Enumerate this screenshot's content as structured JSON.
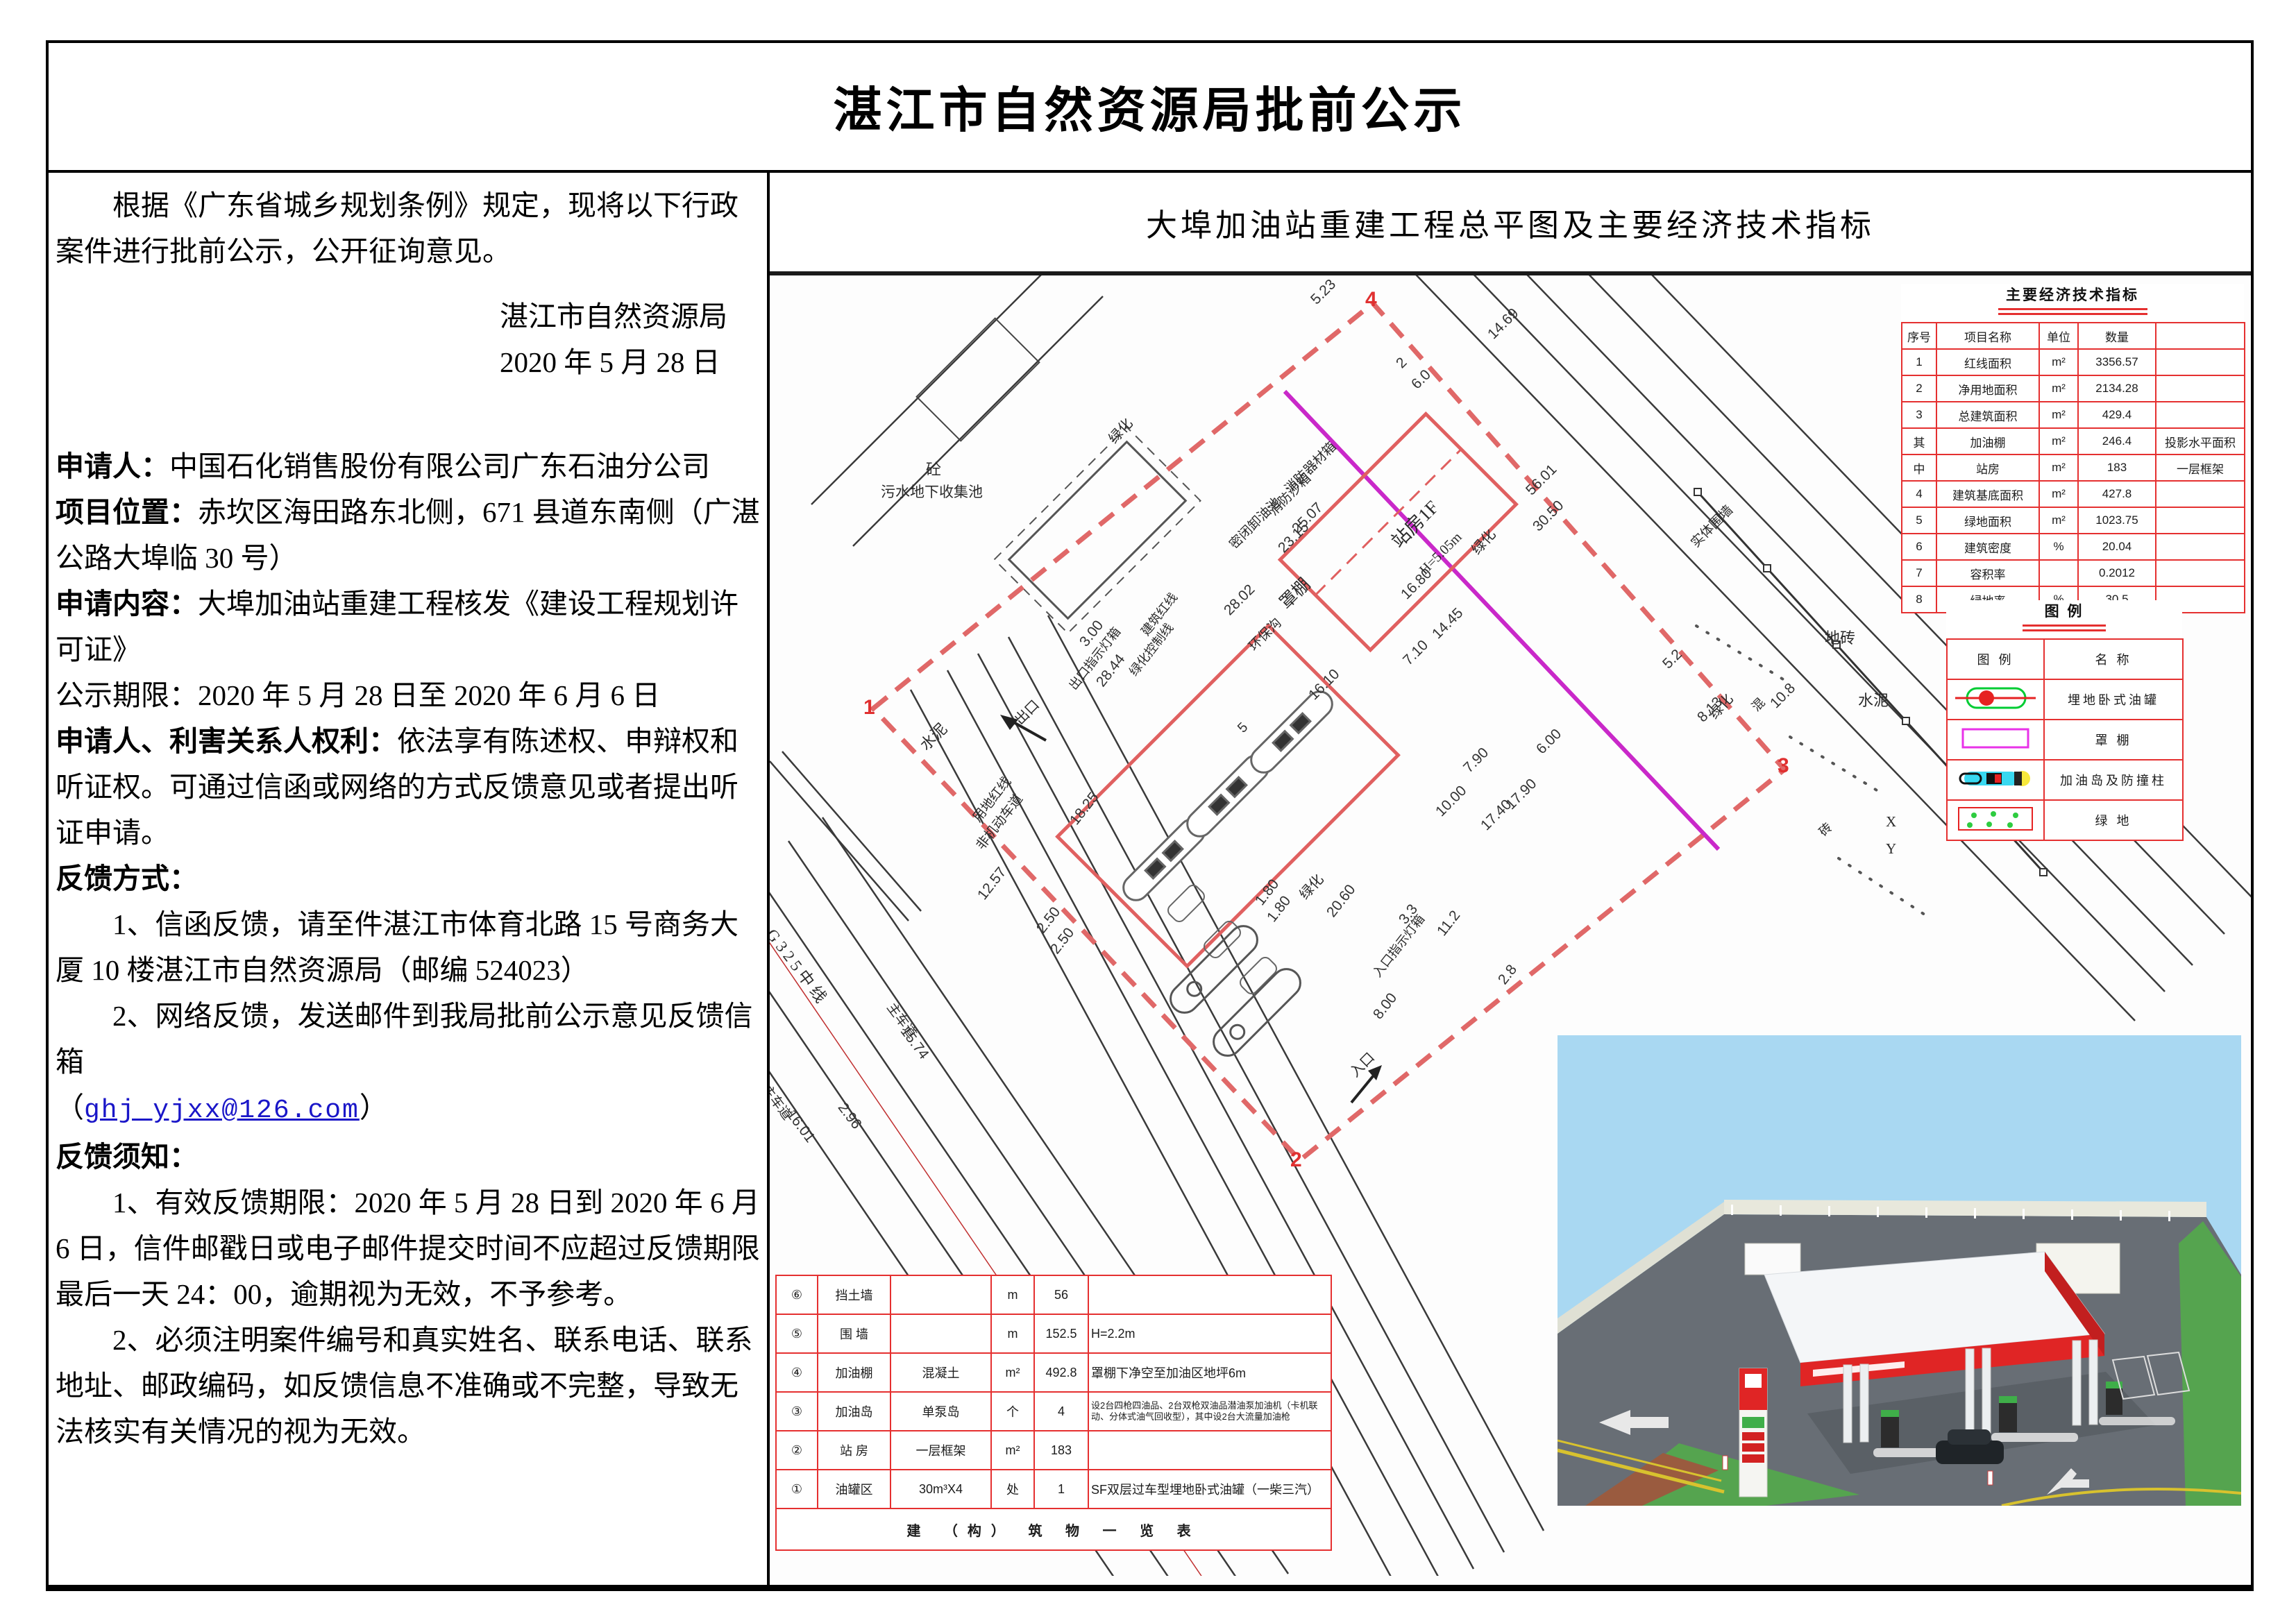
{
  "page": {
    "title": "湛江市自然资源局批前公示"
  },
  "left": {
    "intro": "根据《广东省城乡规划条例》规定，现将以下行政案件进行批前公示，公开征询意见。",
    "org": "湛江市自然资源局",
    "date": "2020 年 5 月 28 日",
    "fields": [
      {
        "label": "申请人：",
        "text": "中国石化销售股份有限公司广东石油分公司",
        "bold": true
      },
      {
        "label": "项目位置：",
        "text": "赤坎区海田路东北侧，671 县道东南侧（广湛公路大埠临 30 号）",
        "bold": true
      },
      {
        "label": "申请内容：",
        "text": "大埠加油站重建工程核发《建设工程规划许可证》",
        "bold": true
      },
      {
        "label": "公示期限：",
        "text": "2020 年 5 月 28 日至 2020 年 6 月 6 日",
        "bold": false
      },
      {
        "label": "申请人、利害关系人权利：",
        "text": "依法享有陈述权、申辩权和听证权。可通过信函或网络的方式反馈意见或者提出听证申请。",
        "bold": true
      }
    ],
    "feedback_method": {
      "heading": "反馈方式：",
      "item1": "1、信函反馈，请至件湛江市体育北路 15 号商务大厦 10 楼湛江市自然资源局（邮编 524023）",
      "item2": "2、网络反馈，发送邮件到我局批前公示意见反馈信箱",
      "paren_open": "（",
      "email": "ghj_yjxx@126.com",
      "paren_close": "）"
    },
    "feedback_notice": {
      "heading": "反馈须知：",
      "item1": "1、有效反馈期限：2020 年 5 月 28 日到 2020 年 6 月 6 日，信件邮戳日或电子邮件提交时间不应超过反馈期限最后一天 24：00，逾期视为无效，不予参考。",
      "item2": "2、必须注明案件编号和真实姓名、联系电话、联系地址、邮政编码，如反馈信息不准确或不完整，导致无法核实有关情况的视为无效。"
    }
  },
  "right": {
    "header": "大埠加油站重建工程总平图及主要经济技术指标"
  },
  "indicators": {
    "title": "主要经济技术指标",
    "headers": [
      "序号",
      "项目名称",
      "单位",
      "数量",
      ""
    ],
    "rows": [
      [
        "1",
        "红线面积",
        "m²",
        "3356.57",
        ""
      ],
      [
        "2",
        "净用地面积",
        "m²",
        "2134.28",
        ""
      ],
      [
        "3",
        "总建筑面积",
        "m²",
        "429.4",
        ""
      ],
      [
        "其",
        "加油棚",
        "m²",
        "246.4",
        "投影水平面积"
      ],
      [
        "中",
        "站房",
        "m²",
        "183",
        "一层框架"
      ],
      [
        "4",
        "建筑基底面积",
        "m²",
        "427.8",
        ""
      ],
      [
        "5",
        "绿地面积",
        "m²",
        "1023.75",
        ""
      ],
      [
        "6",
        "建筑密度",
        "%",
        "20.04",
        ""
      ],
      [
        "7",
        "容积率",
        "",
        "0.2012",
        ""
      ],
      [
        "8",
        "绿地率",
        "%",
        "30.5",
        ""
      ]
    ]
  },
  "legend": {
    "title": "图  例",
    "headers": [
      "图  例",
      "名  称"
    ],
    "rows": [
      {
        "symbol": "tank",
        "name": "埋地卧式油罐"
      },
      {
        "symbol": "canopy",
        "name": "罩  棚"
      },
      {
        "symbol": "island",
        "name": "加油岛及防撞柱"
      },
      {
        "symbol": "green",
        "name": "绿  地"
      }
    ]
  },
  "structures": {
    "rows": [
      {
        "no": "⑥",
        "name": "挡土墙",
        "spec": "",
        "unit": "m",
        "qty": "56",
        "remark": ""
      },
      {
        "no": "⑤",
        "name": "围 墙",
        "spec": "",
        "unit": "m",
        "qty": "152.5",
        "remark": "H=2.2m"
      },
      {
        "no": "④",
        "name": "加油棚",
        "spec": "混凝土",
        "unit": "m²",
        "qty": "492.8",
        "remark": "罩棚下净空至加油区地坪6m"
      },
      {
        "no": "③",
        "name": "加油岛",
        "spec": "单泵岛",
        "unit": "个",
        "qty": "4",
        "remark": "设2台四枪四油品、2台双枪双油品潜油泵加油机（卡机联动、分体式油气回收型），其中设2台大流量加油枪",
        "small": true
      },
      {
        "no": "②",
        "name": "站 房",
        "spec": "一层框架",
        "unit": "m²",
        "qty": "183",
        "remark": ""
      },
      {
        "no": "①",
        "name": "油罐区",
        "spec": "30m³X4",
        "unit": "处",
        "qty": "1",
        "remark": "SF双层过车型埋地卧式油罐（一柴三汽）"
      }
    ],
    "footer": "建 （构） 筑 物 一 览 表"
  },
  "plan": {
    "labels": [
      [
        "砼",
        225,
        262,
        0,
        22,
        "lab"
      ],
      [
        "污水地下收集池",
        160,
        296,
        0,
        21,
        "lab"
      ],
      [
        "绿化",
        480,
        228,
        -48,
        20,
        "lab"
      ],
      [
        "绿化",
        1003,
        388,
        -48,
        20,
        "lab"
      ],
      [
        "绿化",
        755,
        885,
        -48,
        20,
        "lab"
      ],
      [
        "绿化",
        1345,
        625,
        -48,
        20,
        "lab"
      ],
      [
        "消防器材箱",
        735,
        300,
        -45,
        19,
        "lab"
      ],
      [
        "消防沙箱",
        712,
        332,
        -45,
        19,
        "lab"
      ],
      [
        "密闭卸油池",
        655,
        380,
        -45,
        19,
        "lab"
      ],
      [
        "站房1F",
        885,
        372,
        -45,
        27,
        "lab"
      ],
      [
        "H=5.05m",
        932,
        420,
        -45,
        20,
        "lab"
      ],
      [
        "罩棚",
        725,
        462,
        -45,
        25,
        "lab"
      ],
      [
        "环保沟",
        683,
        527,
        -45,
        19,
        "lab"
      ],
      [
        "实体围墙",
        1320,
        378,
        -45,
        19,
        "lab"
      ],
      [
        "地砖",
        1520,
        505,
        0,
        22,
        "lab"
      ],
      [
        "水泥",
        1568,
        595,
        0,
        22,
        "lab"
      ],
      [
        "混",
        1408,
        615,
        -45,
        18,
        "lab"
      ],
      [
        "砖",
        1505,
        795,
        -45,
        18,
        "lab"
      ],
      [
        "X",
        1608,
        775,
        0,
        21,
        "lab"
      ],
      [
        "Y",
        1608,
        814,
        0,
        21,
        "lab"
      ],
      [
        "水泥",
        208,
        668,
        -45,
        22,
        "lab"
      ],
      [
        "出口",
        345,
        632,
        -45,
        20,
        "lab"
      ],
      [
        "出口指示灯箱",
        424,
        586,
        -52,
        18,
        "lab"
      ],
      [
        "入口",
        828,
        1140,
        -45,
        20,
        "lab"
      ],
      [
        "入口指示灯箱",
        862,
        1000,
        -52,
        18,
        "lab"
      ],
      [
        "用地红线",
        285,
        776,
        -52,
        19,
        "lab"
      ],
      [
        "建筑红线",
        528,
        508,
        -52,
        18,
        "lab"
      ],
      [
        "绿化控制线",
        511,
        566,
        -52,
        18,
        "lab"
      ],
      [
        "非机动车道",
        290,
        816,
        -52,
        19,
        "lab"
      ],
      [
        "主车道",
        185,
        1042,
        53,
        19,
        "lab"
      ],
      [
        "主车道",
        5,
        1160,
        53,
        19,
        "lab"
      ],
      [
        "G 3 2 5 中 线",
        16,
        933,
        53,
        23,
        "lab"
      ],
      [
        "14.69",
        1030,
        80,
        -45,
        21,
        "dim"
      ],
      [
        "5.23",
        775,
        30,
        -45,
        21,
        "dim"
      ],
      [
        "6.0",
        920,
        152,
        -45,
        21,
        "dim"
      ],
      [
        "2",
        898,
        122,
        -45,
        21,
        "dim"
      ],
      [
        "56.01",
        1085,
        305,
        -45,
        21,
        "dim"
      ],
      [
        "30.50",
        1095,
        357,
        -45,
        21,
        "dim"
      ],
      [
        "25.07",
        748,
        360,
        -45,
        21,
        "dim"
      ],
      [
        "23.15",
        728,
        388,
        -45,
        21,
        "dim"
      ],
      [
        "28.02",
        650,
        478,
        -45,
        21,
        "dim"
      ],
      [
        "16.10",
        772,
        600,
        -45,
        21,
        "dim"
      ],
      [
        "16.80",
        905,
        455,
        -45,
        21,
        "dim"
      ],
      [
        "14.45",
        950,
        512,
        -45,
        21,
        "dim"
      ],
      [
        "7.10",
        908,
        550,
        -45,
        21,
        "dim"
      ],
      [
        "7.90",
        995,
        705,
        -45,
        21,
        "dim"
      ],
      [
        "10.00",
        955,
        768,
        -45,
        21,
        "dim"
      ],
      [
        "17.40",
        1020,
        788,
        -45,
        21,
        "dim"
      ],
      [
        "17.90",
        1056,
        758,
        -45,
        21,
        "dim"
      ],
      [
        "6.00",
        1100,
        678,
        -45,
        21,
        "dim"
      ],
      [
        "5.2",
        1282,
        555,
        -45,
        21,
        "dim"
      ],
      [
        "10.8",
        1437,
        612,
        -45,
        21,
        "dim"
      ],
      [
        "8.13",
        1332,
        632,
        -45,
        21,
        "dim"
      ],
      [
        "3.00",
        442,
        525,
        -52,
        21,
        "dim"
      ],
      [
        "28.44",
        466,
        583,
        -52,
        21,
        "dim"
      ],
      [
        "12.57",
        295,
        890,
        -52,
        21,
        "dim"
      ],
      [
        "18.25",
        428,
        782,
        -52,
        21,
        "dim"
      ],
      [
        "2.50",
        380,
        938,
        -52,
        21,
        "dim"
      ],
      [
        "2.50",
        400,
        968,
        -52,
        21,
        "dim"
      ],
      [
        "1.80",
        695,
        898,
        -52,
        21,
        "dim"
      ],
      [
        "1.80",
        712,
        922,
        -52,
        21,
        "dim"
      ],
      [
        "20.60",
        798,
        915,
        -52,
        21,
        "dim"
      ],
      [
        "8.00",
        865,
        1062,
        -52,
        21,
        "dim"
      ],
      [
        "3.3",
        902,
        925,
        -52,
        21,
        "dim"
      ],
      [
        "11.2",
        957,
        942,
        -52,
        21,
        "dim"
      ],
      [
        "2.8",
        1045,
        1012,
        -52,
        21,
        "dim"
      ],
      [
        "15.74",
        202,
        1078,
        53,
        21,
        "dim"
      ],
      [
        "16.01",
        38,
        1198,
        53,
        21,
        "dim"
      ],
      [
        "2.96",
        112,
        1188,
        53,
        21,
        "dim"
      ],
      [
        "5",
        670,
        648,
        -45,
        20,
        "dim"
      ],
      [
        "4",
        858,
        18,
        0,
        30,
        "mk"
      ],
      [
        "1",
        135,
        606,
        0,
        30,
        "mk"
      ],
      [
        "2",
        750,
        1258,
        0,
        30,
        "mk"
      ],
      [
        "3",
        1452,
        690,
        0,
        30,
        "mk"
      ]
    ]
  }
}
